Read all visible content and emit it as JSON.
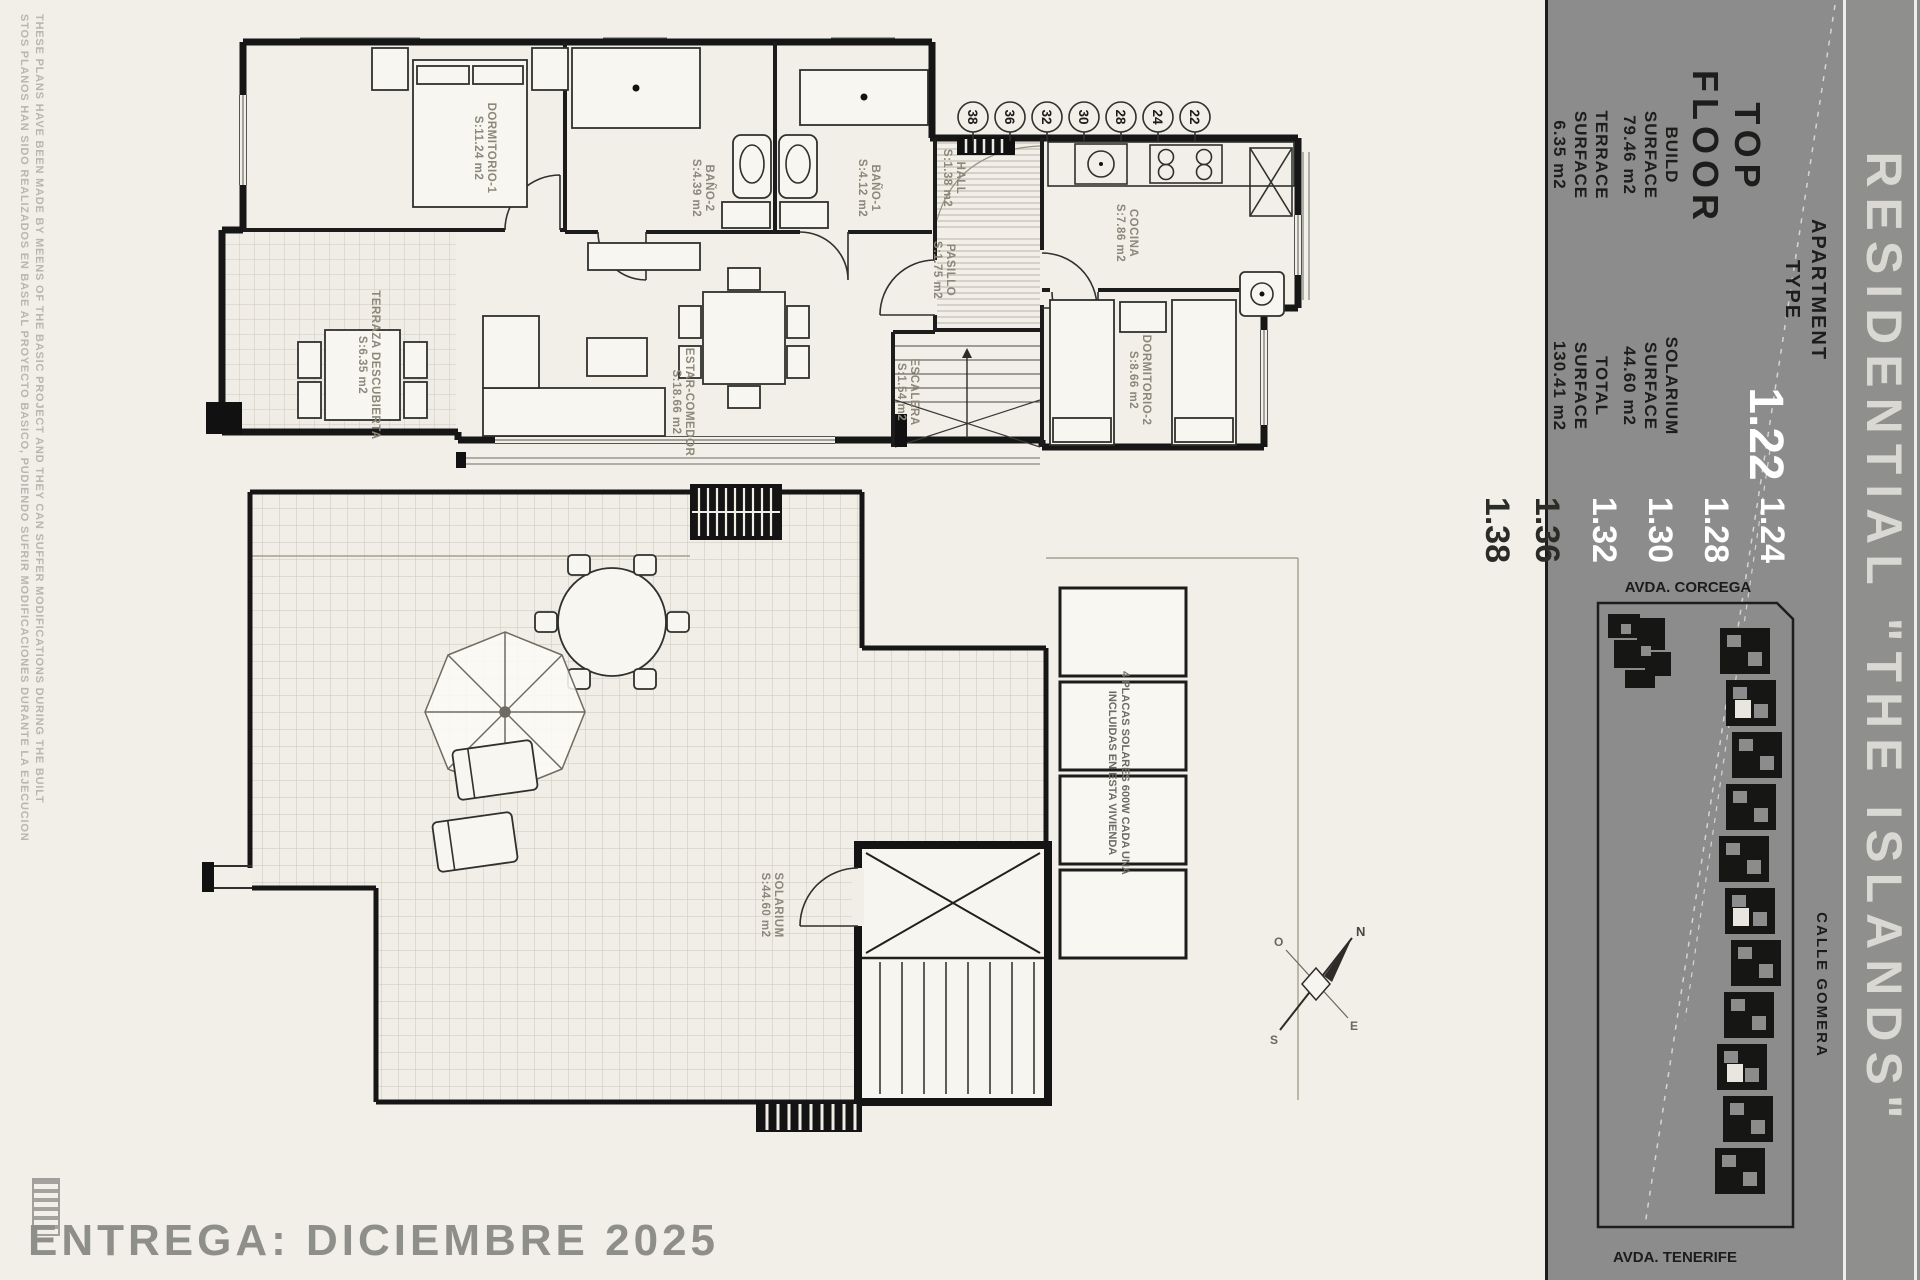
{
  "page": {
    "disclaimer_en": "THESE PLANS HAVE BEEN MADE BY MEENS OF THE BASIC PROJECT AND THEY CAN SUFFER MODIFICATIONS DURING THE BUILT",
    "disclaimer_es": "STOS PLANOS HAN SIDO REALIZADOS EN BASE AL PROYECTO BASICO, PUDIENDO SUFRIR MODIFICACIONES DURANTE LA EJECUCION",
    "delivery": "ENTREGA: DICIEMBRE 2025"
  },
  "title_block": {
    "residential": "RESIDENTIAL \"THE ISLANDS\"",
    "floor_line1": "TOP",
    "floor_line2": "FLOOR",
    "apartment_line1": "APARTMENT",
    "apartment_line2": "TYPE",
    "apartment_main": "1.22",
    "apartment_list": [
      "1.24",
      "1.28",
      "1.30",
      "1.32"
    ],
    "apartment_outside": [
      "1.36",
      "1.38"
    ],
    "surfaces": {
      "build": {
        "name": "BUILD",
        "label": "SURFACE",
        "value": "79.46 m2"
      },
      "solarium": {
        "name": "SOLARIUM",
        "label": "SURFACE",
        "value": "44.60 m2"
      },
      "terrace": {
        "name": "TERRACE",
        "label": "SURFACE",
        "value": "6.35 m2"
      },
      "total": {
        "name": "TOTAL",
        "label": "SURFACE",
        "value": "130.41 m2"
      }
    },
    "streets": {
      "top": "AVDA. CORCEGA",
      "right": "CALLE GOMERA",
      "bottom": "AVDA. TENERIFE"
    }
  },
  "floor_plan": {
    "rooms": {
      "dorm1": {
        "name": "DORMITORIO-1",
        "area": "S:11.24 m2"
      },
      "bano2": {
        "name": "BAÑO-2",
        "area": "S:4.39 m2"
      },
      "bano1": {
        "name": "BAÑO-1",
        "area": "S:4.12 m2"
      },
      "hall": {
        "name": "HALL",
        "area": "S:1.38 m2"
      },
      "cocina": {
        "name": "COCINA",
        "area": "S:7.86 m2"
      },
      "pasillo": {
        "name": "PASILLO",
        "area": "S:1.75 m2"
      },
      "estar": {
        "name": "ESTAR-COMEDOR",
        "area": "S:18.66 m2"
      },
      "terraza": {
        "name": "TERRAZA DESCUBIERTA",
        "area": "S:6.35 m2"
      },
      "escalera": {
        "name": "ESCALERA",
        "area": "S:1.54 m2"
      },
      "dorm2": {
        "name": "DORMITORIO-2",
        "area": "S:8.66 m2"
      }
    },
    "unit_circles": [
      "38",
      "36",
      "32",
      "30",
      "28",
      "24",
      "22"
    ]
  },
  "solarium_plan": {
    "label": {
      "name": "SOLARIUM",
      "area": "S:44.60 m2"
    },
    "solar_note_line1": "4 PLACAS SOLARES 600W CADA UNA",
    "solar_note_line2": "INCLUIDAS EN ESTA VIVIENDA"
  },
  "compass": {
    "n": "N",
    "e": "E",
    "s": "S",
    "w": "O"
  },
  "colors": {
    "paper": "#f1efe8",
    "panel_gray": "#8c8c8c",
    "ink": "#161616",
    "room_label": "#8d877a",
    "residential_text": "#d9d8d2",
    "white_numbers": "#ffffff"
  }
}
